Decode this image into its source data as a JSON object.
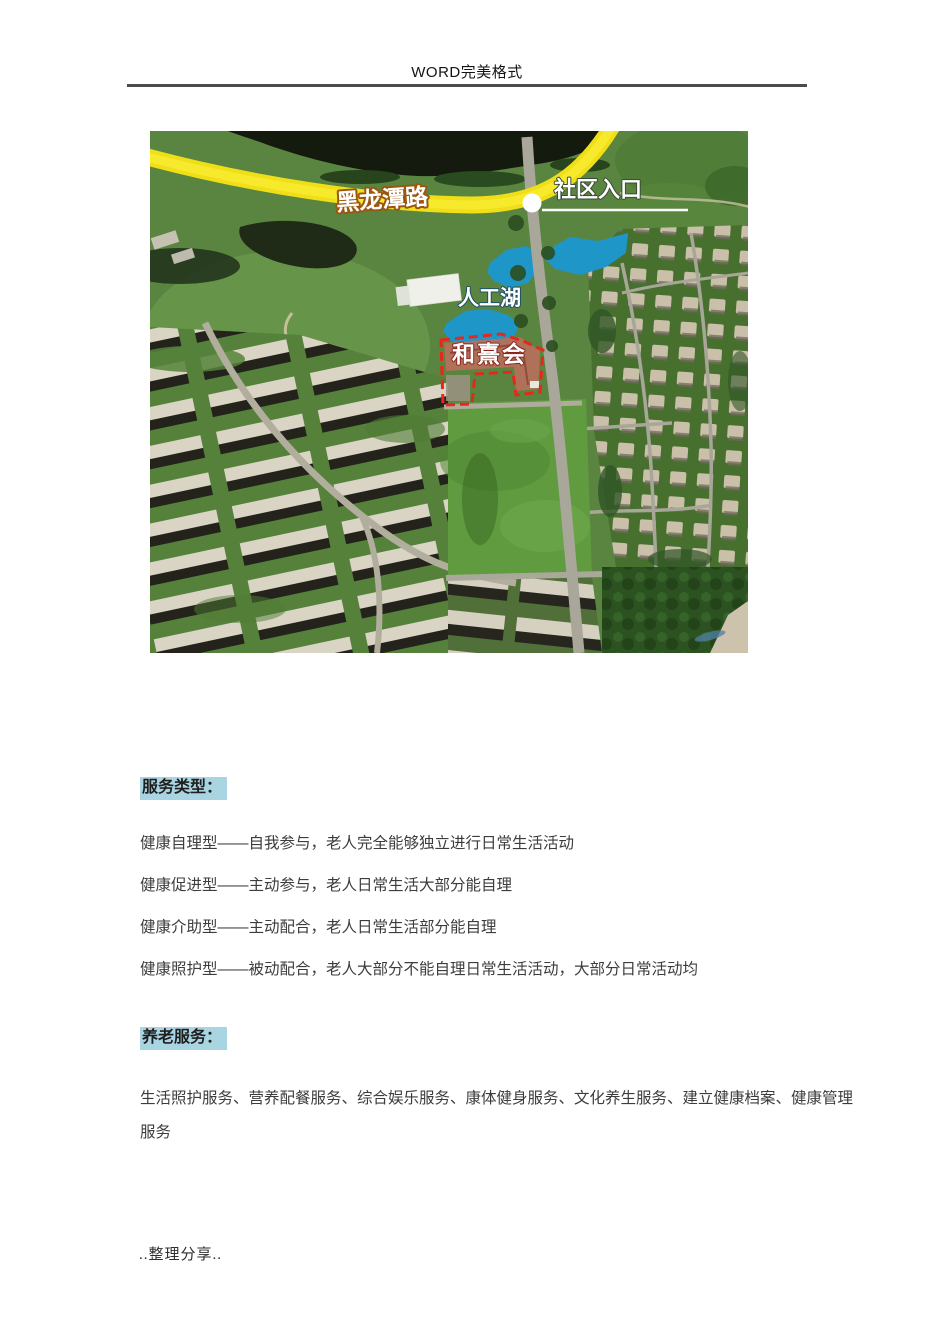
{
  "header": {
    "title": "WORD完美格式"
  },
  "map": {
    "road_label": "黑龙潭路",
    "entrance_label": "社区入口",
    "lake_label": "人工湖",
    "facility_label": "和熹会",
    "colors": {
      "road_highlight": "#f0df18",
      "lake": "#1e96c8",
      "facility_outline": "#e6281c"
    }
  },
  "highlight": {
    "color": "#a9d5e2"
  },
  "sections": [
    {
      "heading": "服务类型：",
      "paragraphs": [
        "健康自理型——自我参与，老人完全能够独立进行日常生活活动",
        "健康促进型——主动参与，老人日常生活大部分能自理",
        "健康介助型——主动配合，老人日常生活部分能自理",
        "健康照护型——被动配合，老人大部分不能自理日常生活活动，大部分日常活动均"
      ]
    },
    {
      "heading": "养老服务：",
      "paragraphs": [
        "生活照护服务、营养配餐服务、综合娱乐服务、康体健身服务、文化养生服务、建立健康档案、健康管理服务"
      ]
    }
  ],
  "footer": {
    "text": "..整理分享.."
  }
}
